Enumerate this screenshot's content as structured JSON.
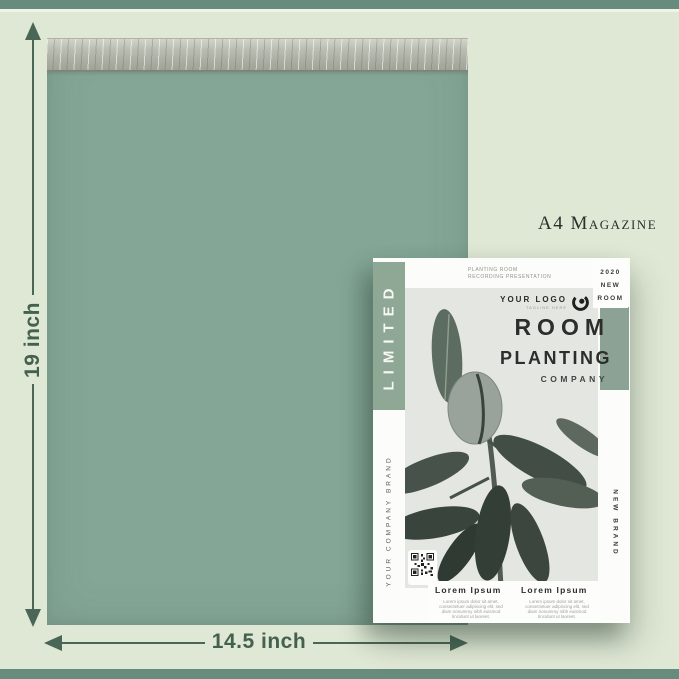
{
  "colors": {
    "background": "#dfe8d4",
    "frame_bar": "#678b7d",
    "bag": "#84a696",
    "adhesive_strip": "#b6b9ad",
    "dimension_annotation": "#44604f",
    "magazine_accent_green": "#8fa795",
    "title_text": "#2d2d2b"
  },
  "annotations": {
    "height_label": "19 inch",
    "width_label": "14.5 inch",
    "size_caption": "A4 Magazine"
  },
  "magazine": {
    "spine_vertical_label": "LIMITED",
    "header": {
      "line1": "PLANTING ROOM",
      "line2": "RECORDING PRESENTATION",
      "issue": [
        "2020",
        "NEW",
        "ROOM"
      ]
    },
    "logo": {
      "text": "YOUR LOGO",
      "tagline": "TAGLINE HERE"
    },
    "title": {
      "line1": "ROOM",
      "line2": "PLANTING",
      "line3": "COMPANY"
    },
    "left_vertical_label": "YOUR COMPANY BRAND",
    "right_vertical_label": "NEW BRAND",
    "articles": [
      {
        "heading": "Lorem Ipsum",
        "body": "Lorem ipsum dolor sit amet, consectetuer adipiscing elit, sed diam nonummy nibh euismod tincidunt ut laoreet."
      },
      {
        "heading": "Lorem Ipsum",
        "body": "Lorem ipsum dolor sit amet, consectetuer adipiscing elit, sed diam nonummy nibh euismod tincidunt ut laoreet."
      }
    ]
  }
}
